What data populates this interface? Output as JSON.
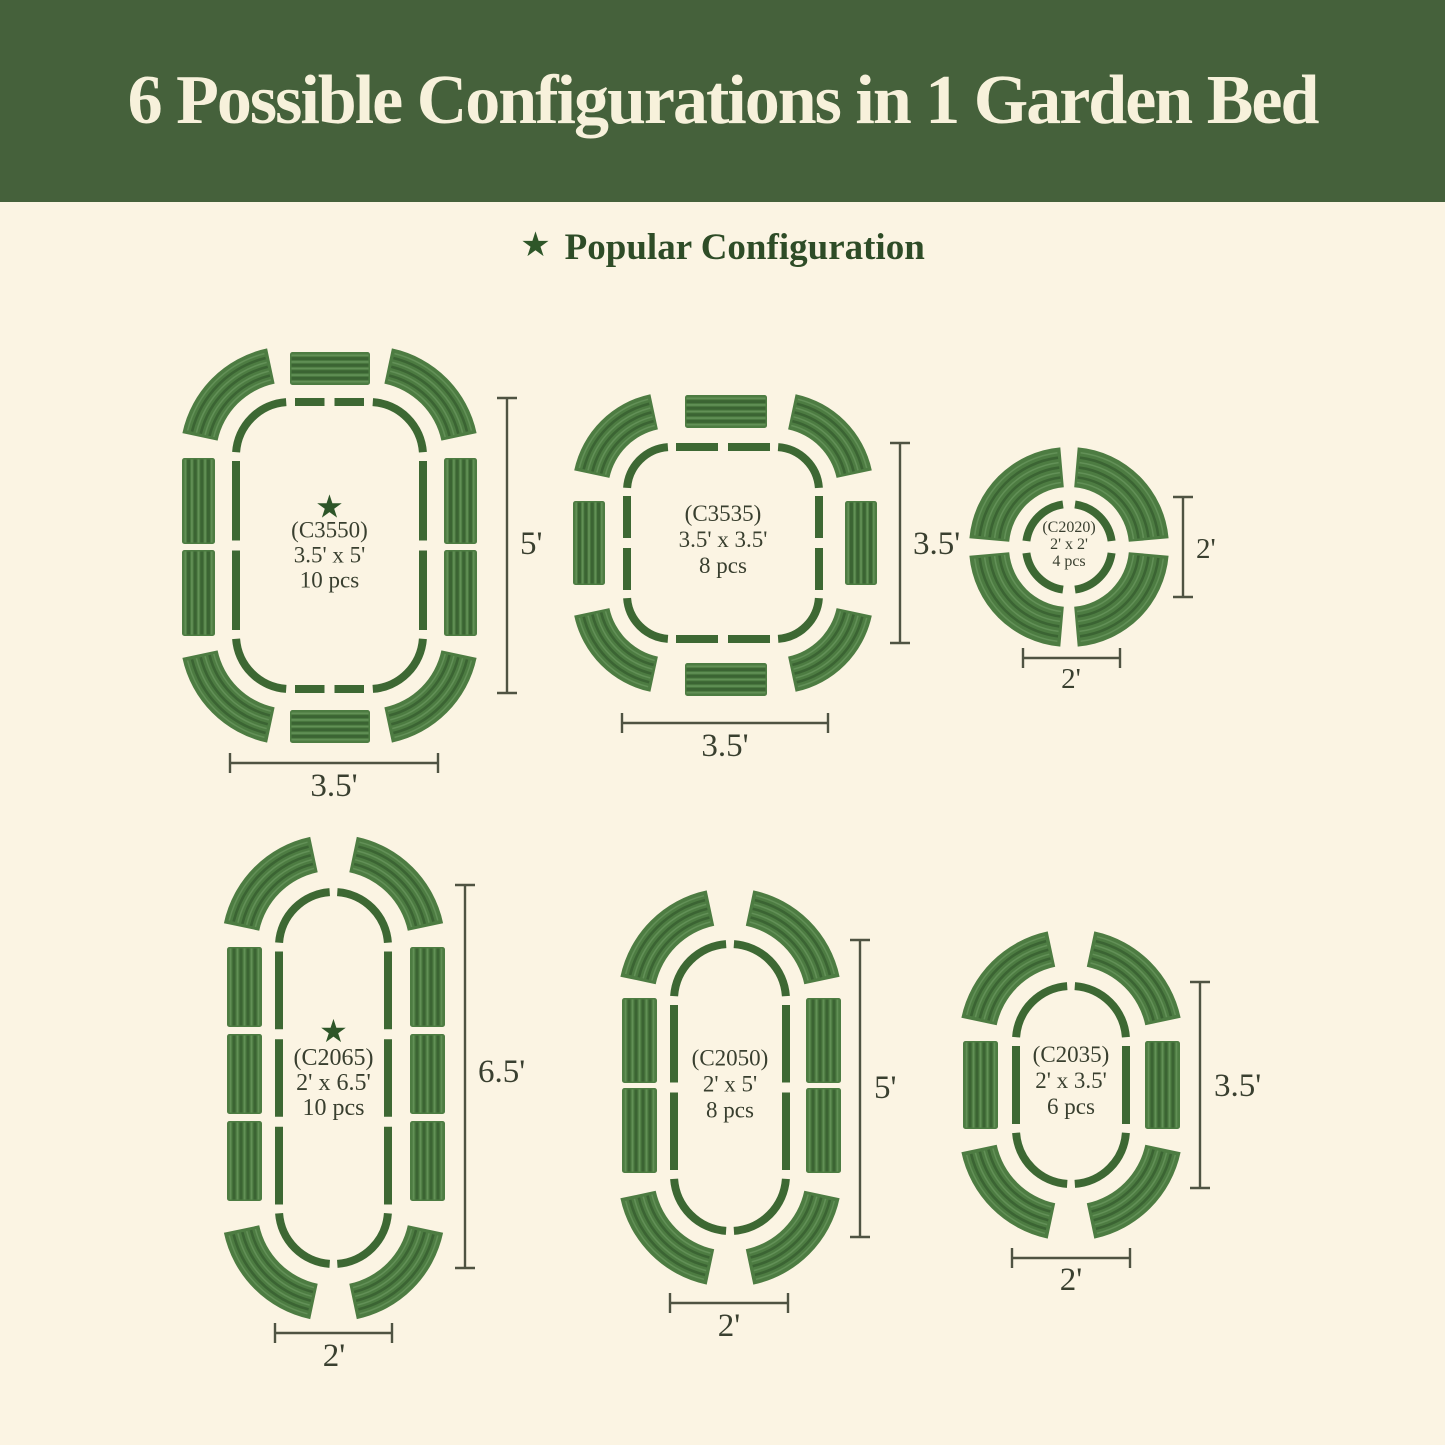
{
  "header": {
    "title": "6 Possible Configurations in 1 Garden Bed"
  },
  "legend": {
    "label": "Popular Configuration"
  },
  "glyphs": {
    "star": "★"
  },
  "colors": {
    "banner_bg": "#45613B",
    "page_bg": "#FBF4E3",
    "title_text": "#F7F1DB",
    "legend_text": "#2E4C27",
    "star_green": "#2E5629",
    "outline_green": "#3D6833",
    "panel_green": "#4D7C42",
    "rib_dark": "#3B6433",
    "rib_light": "#66945A",
    "dim_line": "#4F5342",
    "label_text": "#393F2F"
  },
  "configs": [
    {
      "id": "C3550",
      "code": "(C3550)",
      "size": "3.5' x 5'",
      "pieces": "10 pcs",
      "popular": true,
      "width_label": "3.5'",
      "height_label": "5'"
    },
    {
      "id": "C3535",
      "code": "(C3535)",
      "size": "3.5' x 3.5'",
      "pieces": "8 pcs",
      "popular": false,
      "width_label": "3.5'",
      "height_label": "3.5'"
    },
    {
      "id": "C2020",
      "code": "(C2020)",
      "size": "2' x 2'",
      "pieces": "4 pcs",
      "popular": false,
      "width_label": "2'",
      "height_label": "2'"
    },
    {
      "id": "C2065",
      "code": "(C2065)",
      "size": "2' x 6.5'",
      "pieces": "10 pcs",
      "popular": true,
      "width_label": "2'",
      "height_label": "6.5'"
    },
    {
      "id": "C2050",
      "code": "(C2050)",
      "size": "2' x 5'",
      "pieces": "8 pcs",
      "popular": false,
      "width_label": "2'",
      "height_label": "5'"
    },
    {
      "id": "C2035",
      "code": "(C2035)",
      "size": "2' x 3.5'",
      "pieces": "6 pcs",
      "popular": false,
      "width_label": "2'",
      "height_label": "3.5'"
    }
  ]
}
